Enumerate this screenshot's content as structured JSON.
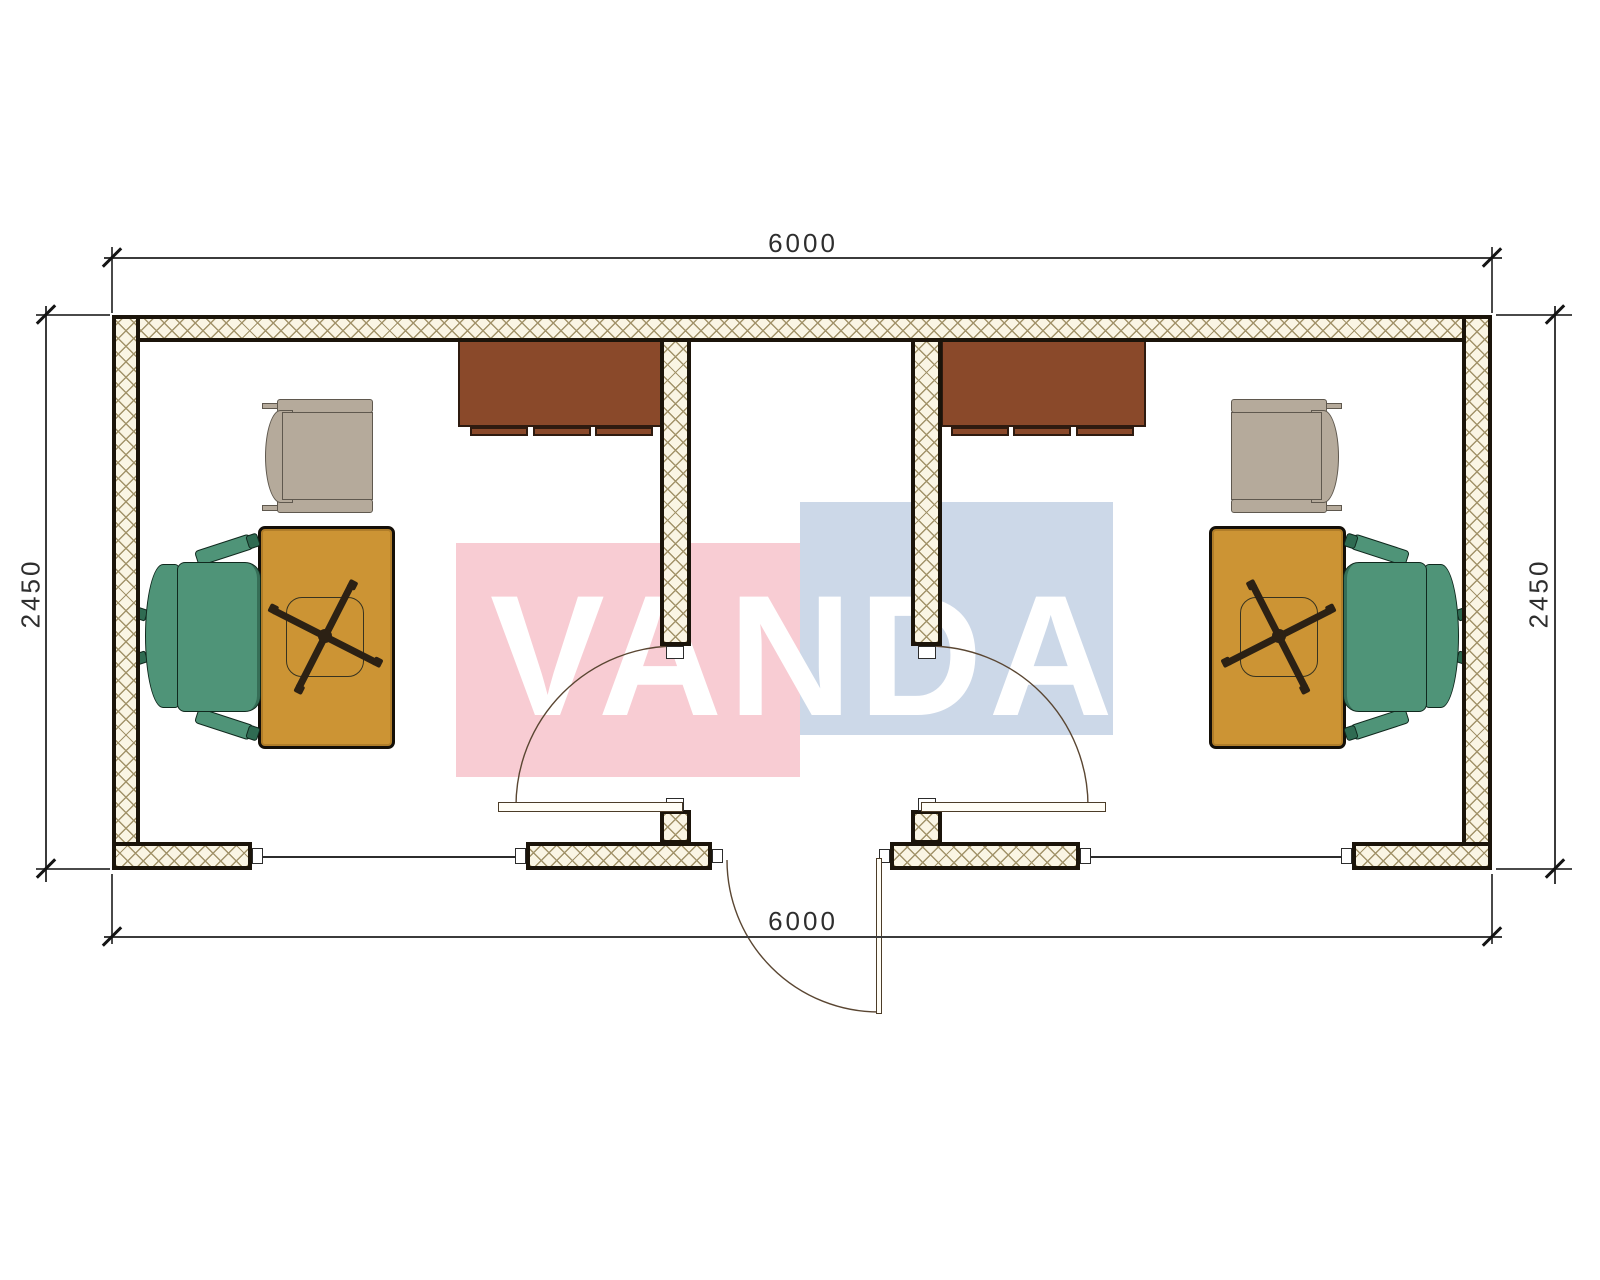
{
  "drawing": {
    "kind": "office-container-floor-plan",
    "dimensions": {
      "top": "6000",
      "bottom": "6000",
      "left": "2450",
      "right": "2450"
    },
    "watermark": {
      "text": "VANDA",
      "red_block_color": "#f8ccd3",
      "blue_block_color": "#ccd8e8",
      "text_color": "#ffffff"
    },
    "colors": {
      "wall_outline": "#1b140a",
      "wall_hatch_line": "#a2936a",
      "wall_hatch_bg": "#faf5e4",
      "cabinet": "#8a492a",
      "desk": "#cc9434",
      "task_chair": "#4f9478",
      "guest_chair": "#b5aa9b",
      "door_arc": "#5a4632"
    },
    "rooms": [
      {
        "name": "office-left",
        "furniture": [
          "wardrobe-cabinet",
          "guest-armchair",
          "desk",
          "swivel-chair-base",
          "task-chair"
        ]
      },
      {
        "name": "office-right",
        "furniture": [
          "wardrobe-cabinet",
          "guest-armchair",
          "desk",
          "swivel-chair-base",
          "task-chair"
        ]
      }
    ]
  }
}
